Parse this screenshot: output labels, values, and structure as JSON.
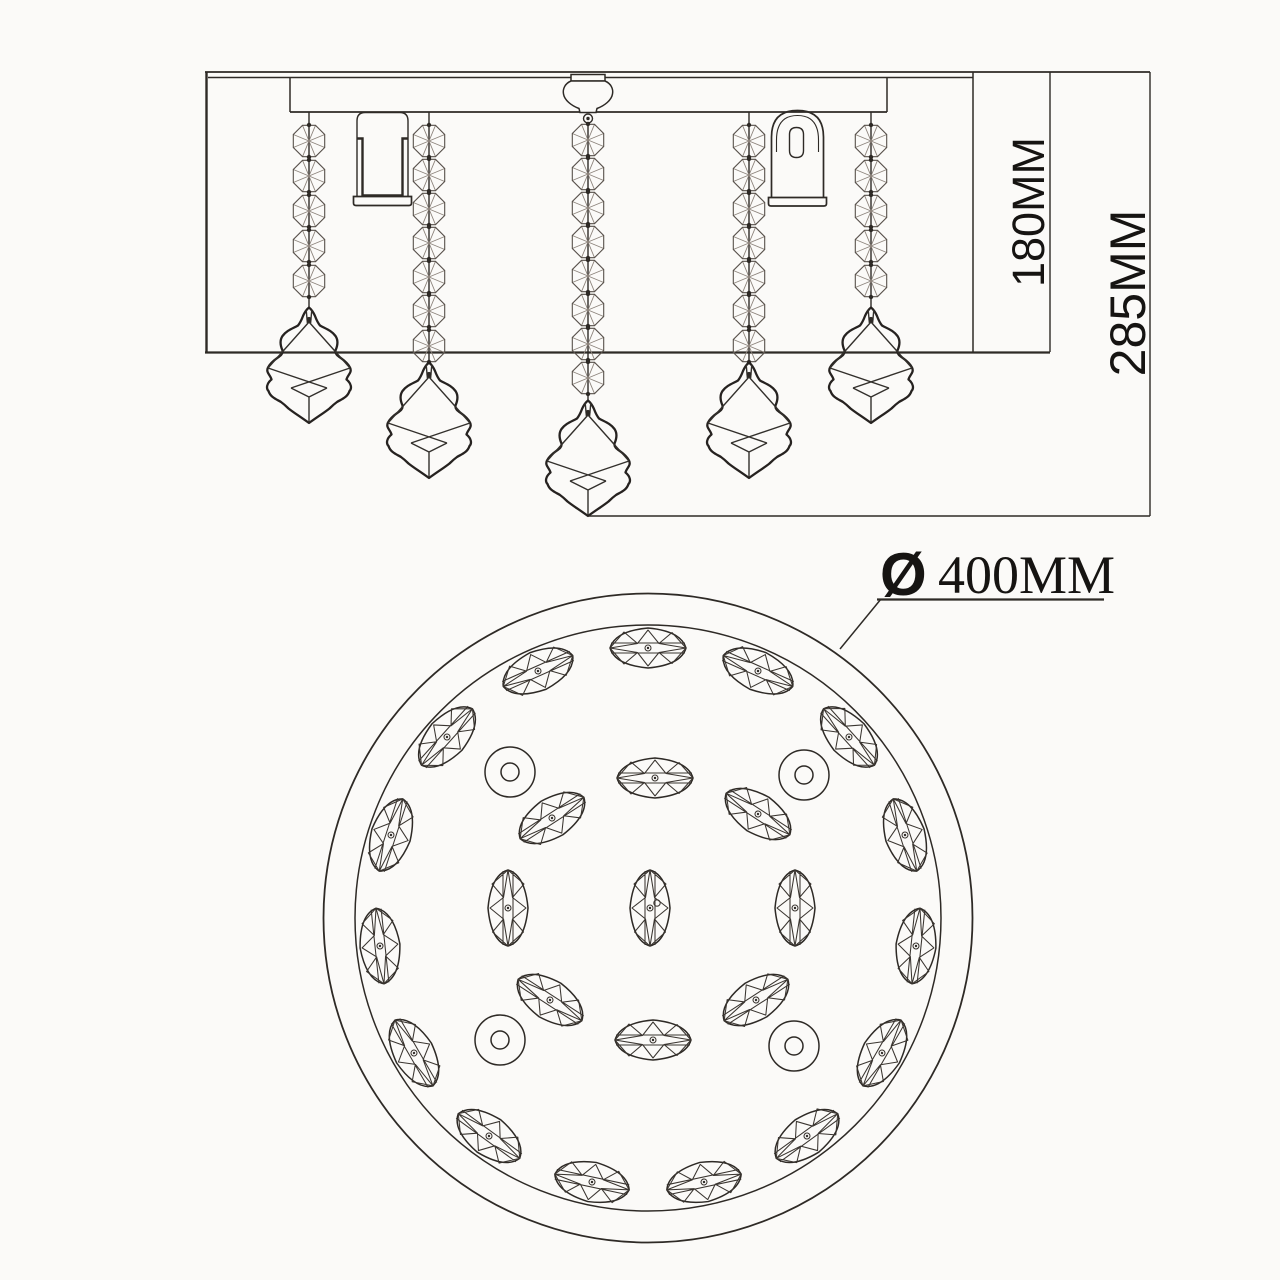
{
  "colors": {
    "background": "#fbfaf8",
    "ink": "#2e2a26",
    "light_line": "#8d847c"
  },
  "dimensions": {
    "inner_height": {
      "label": "180MM"
    },
    "overall_height": {
      "label": "285MM"
    },
    "diameter": {
      "symbol": "Ø",
      "value": "400MM"
    }
  }
}
